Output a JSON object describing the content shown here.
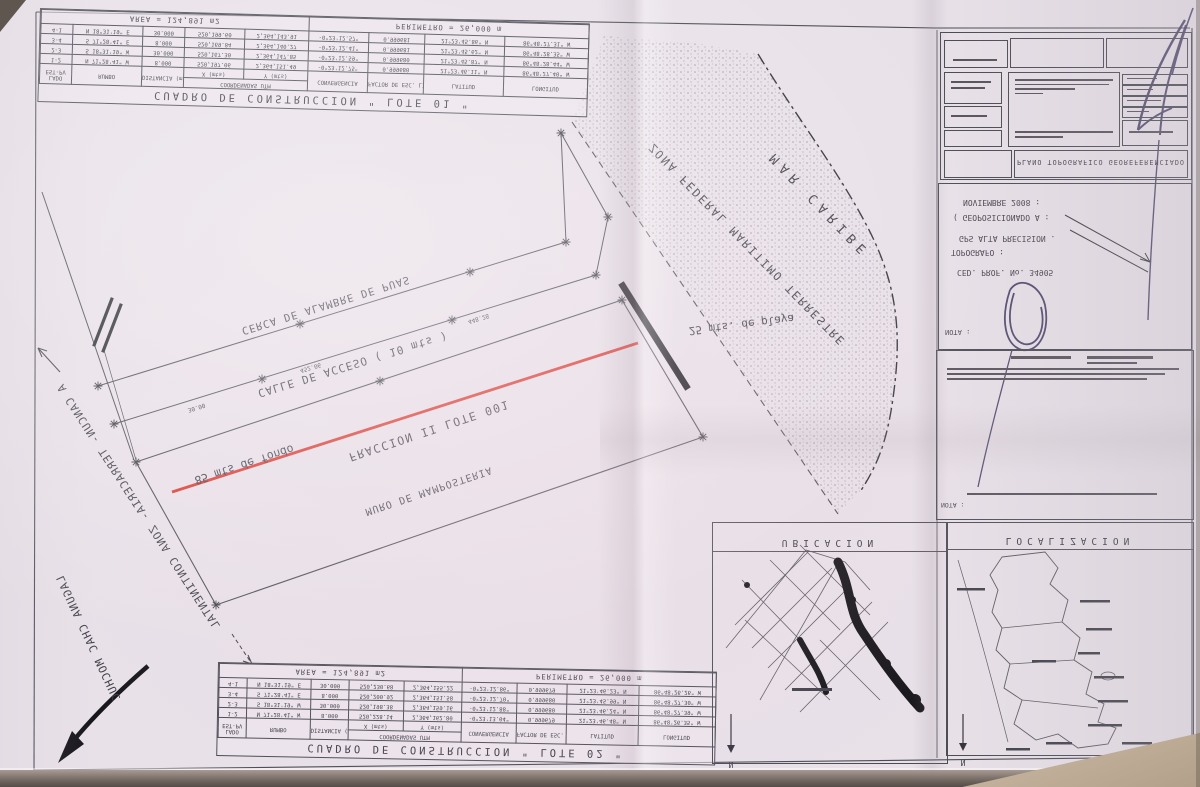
{
  "paper": {
    "background": "#e8e1e8",
    "line_color": "#4a4a54",
    "red_accent": "#d9342b",
    "pen_ink": "#39325a"
  },
  "table_lote01": {
    "title": "CUADRO DE CONSTRUCCION \" LOTE 01 \"",
    "area_label": "AREA = 124,891 m2",
    "perimeter_label": "PERIMETRO = 26,000 m",
    "headers": {
      "lado": "LADO",
      "lado_sub": "EST-PV",
      "rumbo": "RUMBO",
      "dist": "DISTANCIA (mts)",
      "coord": "COORDENADAS UTM",
      "coord_x": "X (mts)",
      "coord_y": "Y (mts)",
      "conv": "CONVERGENCIA",
      "factor": "FACTOR DE ESC. LINEAL",
      "lat": "LATITUD",
      "lon": "LONGITUD"
    },
    "rows": [
      {
        "lado": "1-2",
        "rumbo": "N 71°28'41\" W",
        "dist": "8.000",
        "x": "520,197.06",
        "y": "2,364,151.49",
        "conv": "-0°23'12.75\"",
        "factor": "0.999680",
        "lat": "21°23'46.11\" N",
        "lon": "86°48'27.40\" W"
      },
      {
        "lado": "2-3",
        "rumbo": "S 18°31'19\" W",
        "dist": "30.000",
        "x": "520,167.30",
        "y": "2,364,147.85",
        "conv": "-0°23'12.59\"",
        "factor": "0.999680",
        "lat": "21°23'45.87\" N",
        "lon": "86°48'28.44\" W"
      },
      {
        "lado": "3-4",
        "rumbo": "S 71°28'41\" E",
        "dist": "8.000",
        "x": "520,169.84",
        "y": "2,364,140.27",
        "conv": "-0°23'12.41\"",
        "factor": "0.999681",
        "lat": "21°23'45.62\" N",
        "lon": "86°48'28.35\" W"
      },
      {
        "lado": "4-1",
        "rumbo": "N 18°31'19\" E",
        "dist": "30.000",
        "x": "520,199.60",
        "y": "2,364,143.91",
        "conv": "-0°23'12.57\"",
        "factor": "0.999681",
        "lat": "21°23'45.86\" N",
        "lon": "86°48'27.31\" W"
      }
    ]
  },
  "table_lote02": {
    "title": "CUADRO DE CONSTRUCCION \" LOTE 02 \"",
    "area_label": "AREA = 124,891 m2",
    "perimeter_label": "PERIMETRO = 26,000 m",
    "rows": [
      {
        "lado": "1-2",
        "rumbo": "N 71°28'41\" W",
        "dist": "8.000",
        "x": "520,228.14",
        "y": "2,364,162.80",
        "conv": "-0°23'13.04\"",
        "factor": "0.999679",
        "lat": "21°23'46.48\" N",
        "lon": "86°48'26.35\" W"
      },
      {
        "lado": "2-3",
        "rumbo": "S 18°31'19\" W",
        "dist": "30.000",
        "x": "520,198.38",
        "y": "2,364,159.16",
        "conv": "-0°23'12.88\"",
        "factor": "0.999680",
        "lat": "21°23'46.24\" N",
        "lon": "86°48'27.39\" W"
      },
      {
        "lado": "3-4",
        "rumbo": "S 71°28'41\" E",
        "dist": "8.000",
        "x": "520,200.92",
        "y": "2,364,151.58",
        "conv": "-0°23'12.70\"",
        "factor": "0.999680",
        "lat": "21°23'45.99\" N",
        "lon": "86°48'27.30\" W"
      },
      {
        "lado": "4-1",
        "rumbo": "N 18°31'19\" E",
        "dist": "30.000",
        "x": "520,230.68",
        "y": "2,364,155.22",
        "conv": "-0°23'12.86\"",
        "factor": "0.999679",
        "lat": "21°23'46.23\" N",
        "lon": "86°48'26.26\" W"
      }
    ]
  },
  "map_labels": {
    "mar_caribe": "MAR CARIBE",
    "zofemat": "ZONA FEDERAL MARITIMO TERRESTRE",
    "playa_red": "25 mts. de playa",
    "fondo_red": "85 mts de fondo",
    "calle": "CALLE DE ACCESO ( 10 mts )",
    "cerca": "CERCA DE ALAMBRE DE PUAS",
    "fraccion": "FRACCION II LOTE 001",
    "muro": "MURO DE MAMPOSTERIA",
    "cancun": "A CANCUN- TERRACERIA- ZONA CONTINENTAL",
    "laguna": "LAGUNA CHAC MOCHUC",
    "dims": [
      "452.06",
      "448.28",
      "30.00"
    ]
  },
  "panel": {
    "plano_title": "PLANO TOPOGRAFICO GEOREFERENCIADO",
    "notes_lines": [
      "NOVIEMBRE 2008 :",
      "( GEOPOSICIONADO A :",
      "GPS ALTA PRECISION .",
      "TOPOGRAFO :",
      "CED. PROF. No. 34905"
    ],
    "nota_label": "NOTA :",
    "nota_label2": "NOTA :",
    "ubicacion_title": "UBICACION",
    "localizacion_title": "LOCALIZACION",
    "north_label": "N"
  }
}
